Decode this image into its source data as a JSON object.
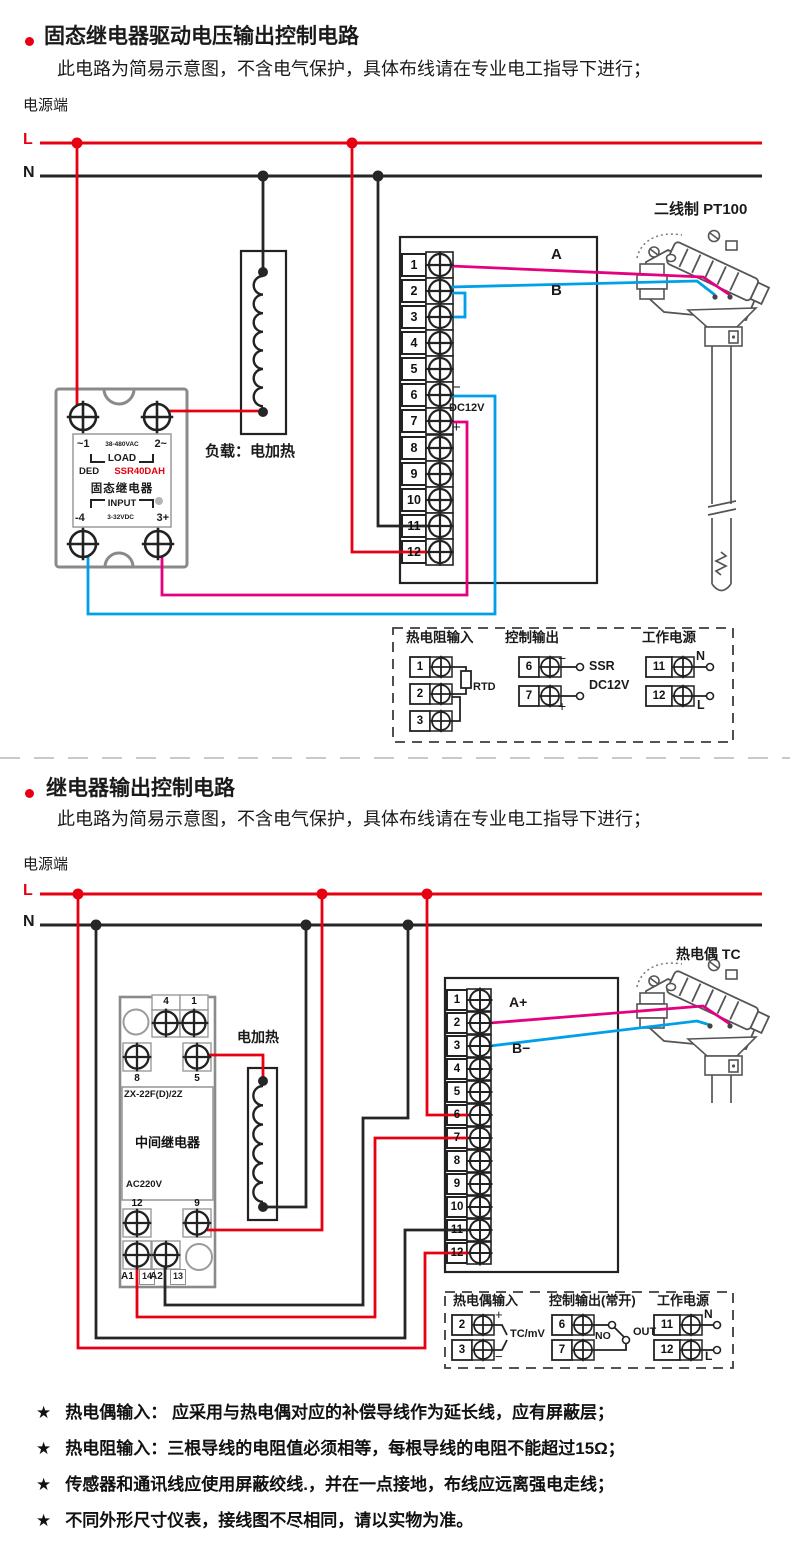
{
  "colors": {
    "red": "#e60012",
    "black": "#262626",
    "magenta": "#e5007f",
    "blue": "#00a0e9",
    "gray": "#8a8a8a"
  },
  "s1": {
    "title": "固态继电器驱动电压输出控制电路",
    "subtitle": "此电路为简易示意图，不含电气保护，具体布线请在专业电工指导下进行；",
    "power_label": "电源端",
    "l": "L",
    "n": "N",
    "ssr": {
      "r1l": "~1",
      "r1m": "38-480VAC",
      "r1r": "2~",
      "load": "LOAD",
      "brand": "DED",
      "model": "SSR40DAH",
      "name": "固态继电器",
      "input": "INPUT",
      "r6l": "-4",
      "r6m": "3-32VDC",
      "r6r": "3+"
    },
    "load_label": "负载：电加热",
    "terminals": [
      "1",
      "2",
      "3",
      "4",
      "5",
      "6",
      "7",
      "8",
      "9",
      "10",
      "11",
      "12"
    ],
    "wire_a": "A",
    "wire_b": "B",
    "minus": "−",
    "plus": "+",
    "dc12v": "DC12V",
    "sensor_label": "二线制 PT100",
    "panel": {
      "rtd_title": "热电阻输入",
      "t1": "1",
      "t2": "2",
      "t3": "3",
      "rtd": "RTD",
      "out_title": "控制输出",
      "t6": "6",
      "t7": "7",
      "minus": "−",
      "plus": "+",
      "ssr": "SSR",
      "dc12v": "DC12V",
      "pwr_title": "工作电源",
      "t11": "11",
      "t12": "12",
      "n": "N",
      "l": "L"
    }
  },
  "s2": {
    "title": "继电器输出控制电路",
    "subtitle": "此电路为简易示意图，不含电气保护，具体布线请在专业电工指导下进行；",
    "power_label": "电源端",
    "l": "L",
    "n": "N",
    "relay": {
      "n4": "4",
      "n1": "1",
      "n8": "8",
      "n5": "5",
      "model": "ZX-22F(D)/2Z",
      "name": "中间继电器",
      "volt": "AC220V",
      "n12": "12",
      "n9": "9",
      "a1": "A1",
      "n14": "14",
      "a2": "A2",
      "n13": "13"
    },
    "heater_label": "电加热",
    "terminals": [
      "1",
      "2",
      "3",
      "4",
      "5",
      "6",
      "7",
      "8",
      "9",
      "10",
      "11",
      "12"
    ],
    "wire_a": "A+",
    "wire_b": "B−",
    "sensor_label": "热电偶 TC",
    "panel": {
      "tc_title": "热电偶输入",
      "t2": "2",
      "t3": "3",
      "plus": "+",
      "minus": "−",
      "tc": "TC/mV",
      "out_title": "控制输出(常开)",
      "t6": "6",
      "t7": "7",
      "no": "NO",
      "out": "OUT",
      "pwr_title": "工作电源",
      "t11": "11",
      "t12": "12",
      "n": "N",
      "l": "L"
    }
  },
  "notes": {
    "star": "★",
    "items": [
      "热电偶输入： 应采用与热电偶对应的补偿导线作为延长线，应有屏蔽层；",
      "热电阻输入：三根导线的电阻值必须相等，每根导线的电阻不能超过15Ω；",
      "传感器和通讯线应使用屏蔽绞线.，并在一点接地，布线应远离强电走线；",
      "不同外形尺寸仪表，接线图不尽相同，请以实物为准。"
    ]
  }
}
